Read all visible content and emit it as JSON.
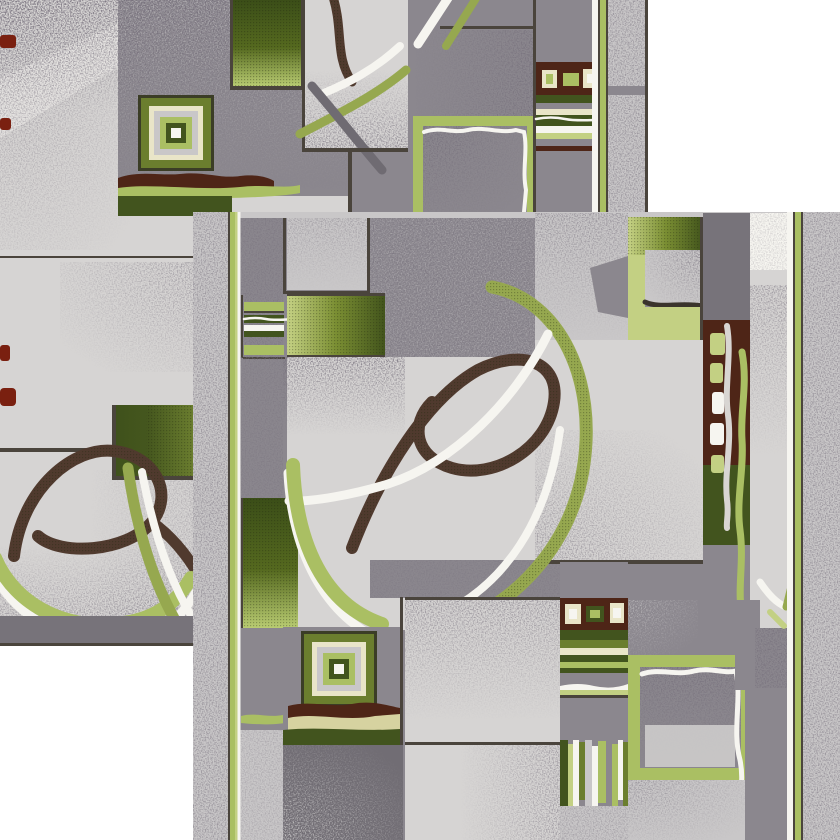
{
  "artwork": {
    "kind": "carpet-pattern-photo",
    "description": "Two overlapping panels of a geometric carpet runner pattern in gray and green tones with speckled texture, swirl ribbons, nested squares, gradient blocks, striped insets and pinstripe borders on a white background",
    "width": 840,
    "height": 840
  },
  "palette": {
    "white": "#ffffff",
    "offWhite": "#f6f5f0",
    "cream": "#e9e5c8",
    "khaki": "#d6d2a0",
    "greenPale": "#c3d083",
    "greenLight": "#aabf63",
    "oliveMid": "#6b7e2e",
    "oliveDark": "#42541e",
    "ringDark": "#3b3d26",
    "panelLight": "#d6d4d3",
    "panelMist": "#c9c7c8",
    "panelMid": "#8b878e",
    "panelDark": "#77737a",
    "panelDark2": "#716d74",
    "lineDark": "#4a443c",
    "maroon": "#4e2517",
    "redEdge": "#7a2010",
    "ribbonBrown": "#503a2e",
    "ribbonGray": "#6f6b72",
    "ribbonGreen": "#96a84f",
    "ribbonWhiteGray": "#d8d5d2",
    "speckle": "#2b282e"
  },
  "panels": [
    {
      "label": "upper-left carpet panel"
    },
    {
      "label": "lower-right carpet panel"
    }
  ],
  "motifs": [
    "nested-squares",
    "wavy-band",
    "gradient-square",
    "striped-inset",
    "maroon-panel-with-squares",
    "swirl-ribbon",
    "x-ribbon",
    "vertical-bars",
    "wavy-frame-square",
    "pinstripe-border",
    "speckled-border-strip"
  ]
}
